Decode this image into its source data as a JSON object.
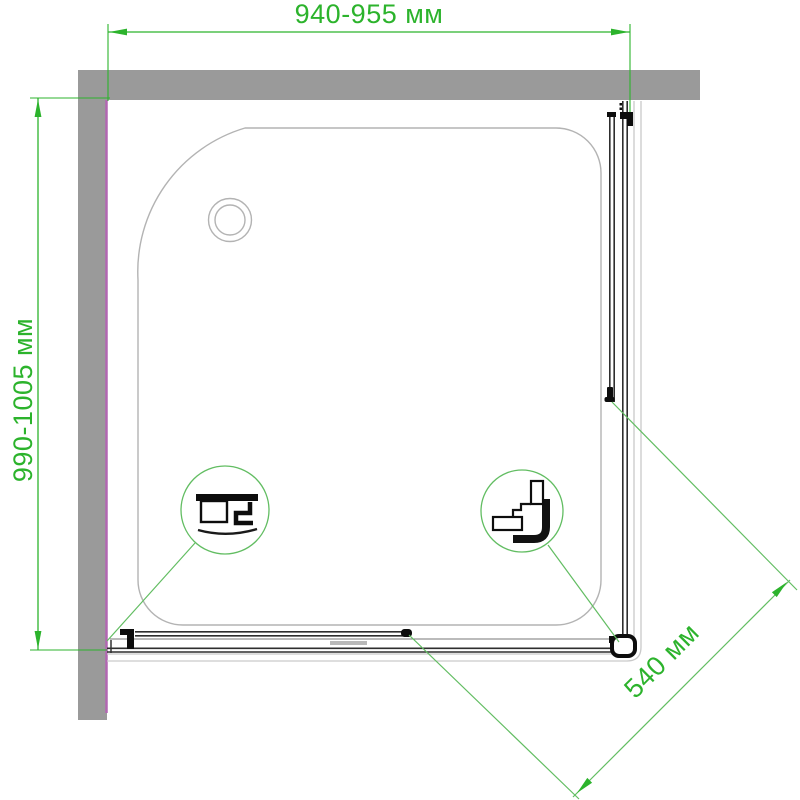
{
  "drawing": {
    "type": "shower-enclosure-installation-diagram",
    "dimensions": {
      "top": {
        "label": "940-955 мм"
      },
      "left": {
        "label": "990-1005 мм"
      },
      "diagonal": {
        "label": "540 мм"
      }
    },
    "callouts": {
      "left": {
        "name": "bottom-rail-profile-detail"
      },
      "right": {
        "name": "corner-bracket-profile-detail"
      }
    }
  },
  "colors": {
    "dimension_green": "#2cb32c",
    "callout_green": "#62bd62",
    "wall_gray": "#9a9a9a",
    "profile_magenta": "#b266b2",
    "outline_gray": "#b3b3b3",
    "outer_gray": "#c9c9c9",
    "frame_dark": "#2e2e2e",
    "frame_black": "#0d0d0d"
  }
}
